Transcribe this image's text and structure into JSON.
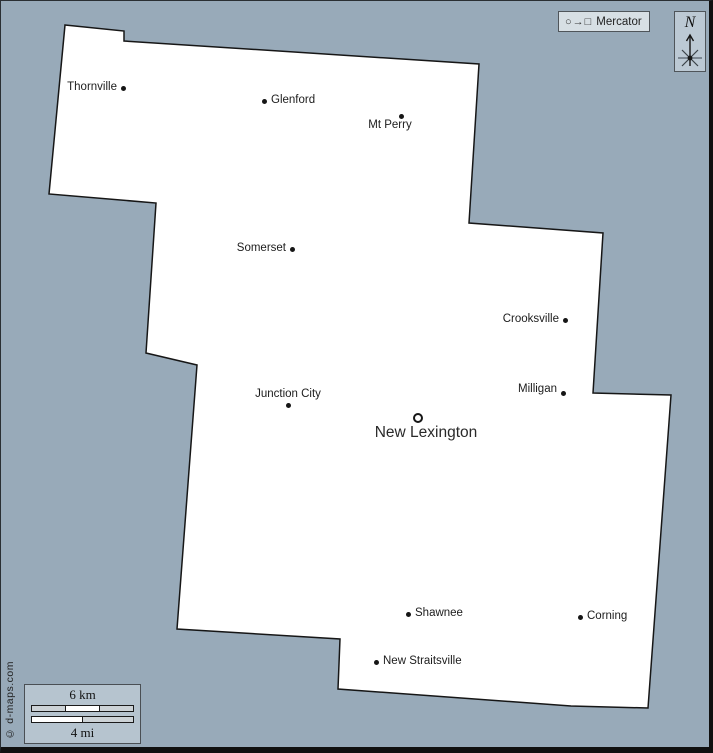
{
  "legend": {
    "projection_symbols": "○→□",
    "projection_label": "Mercator"
  },
  "compass": {
    "label": "N"
  },
  "scale": {
    "km_label": "6 km",
    "mi_label": "4 mi"
  },
  "copyright": "© d-maps.com",
  "cities": [
    {
      "name": "Thornville",
      "marker": "dot",
      "label_side": "left"
    },
    {
      "name": "Glenford",
      "marker": "dot",
      "label_side": "right"
    },
    {
      "name": "Mt Perry",
      "marker": "dot",
      "label_side": "below"
    },
    {
      "name": "Somerset",
      "marker": "dot",
      "label_side": "left"
    },
    {
      "name": "Crooksville",
      "marker": "dot",
      "label_side": "left"
    },
    {
      "name": "Milligan",
      "marker": "dot",
      "label_side": "left"
    },
    {
      "name": "Junction City",
      "marker": "dot",
      "label_side": "above"
    },
    {
      "name": "New Lexington",
      "marker": "ring",
      "label_side": "below",
      "county_seat": true
    },
    {
      "name": "Shawnee",
      "marker": "dot",
      "label_side": "right"
    },
    {
      "name": "Corning",
      "marker": "dot",
      "label_side": "right"
    },
    {
      "name": "New Straitsville",
      "marker": "dot",
      "label_side": "right"
    }
  ],
  "colors": {
    "background": "#98aab9",
    "county_fill": "#ffffff",
    "outline": "#161616"
  }
}
